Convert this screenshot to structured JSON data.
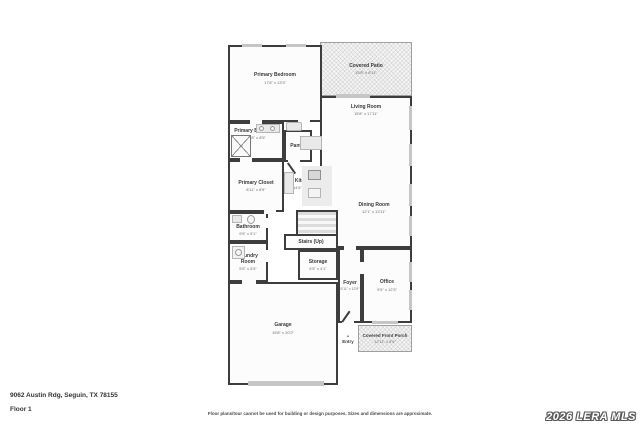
{
  "page": {
    "address": "9062 Austin Rdg, Seguin, TX 78155",
    "floor_label": "Floor 1",
    "disclaimer": "Floor plans/tour cannot be used for building or design purposes. Sizes and dimensions are approximate.",
    "watermark": "2026 LERA MLS"
  },
  "colors": {
    "wall": "#3d3d3d",
    "room_fill": "#fcfcfc",
    "fixture": "#e9e9e9",
    "window_marker": "#c6c6c6",
    "hatch_fill": "#f5f5f5",
    "label_text": "#3a3a3a",
    "dims_text": "#6e6e6e"
  },
  "rooms": {
    "primary_bedroom": {
      "name": "Primary Bedroom",
      "dims": "17'8\" x 13'3\""
    },
    "covered_patio": {
      "name": "Covered Patio",
      "dims": "15'8\" x 8'11\""
    },
    "living_room": {
      "name": "Living Room",
      "dims": "15'8\" x 17'11\""
    },
    "primary_bathroom": {
      "name": "Primary Bathroom",
      "dims": "10'8\" x 8'5\""
    },
    "pantry": {
      "name": "Pantry"
    },
    "primary_closet": {
      "name": "Primary Closet",
      "dims": "8'11\" x 8'9\""
    },
    "kitchen": {
      "name": "Kitchen",
      "dims": "14'6\" x 15'3\""
    },
    "dining_room": {
      "name": "Dining Room",
      "dims": "12'1\" x 13'11\""
    },
    "bathroom": {
      "name": "Bathroom",
      "dims": "9'5\" x 5'1\""
    },
    "laundry_room": {
      "name": "Laundry Room",
      "dims": "5'5\" x 5'9\""
    },
    "stairs": {
      "name": "Stairs (Up)"
    },
    "storage": {
      "name": "Storage",
      "dims": "5'5\" x 4'1\""
    },
    "office": {
      "name": "Office",
      "dims": "9'5\" x 12'3\""
    },
    "foyer": {
      "name": "Foyer",
      "dims": "5'11\" x 12'9\""
    },
    "garage": {
      "name": "Garage",
      "dims": "19'8\" x 20'2\""
    },
    "entry": {
      "name": "Entry"
    },
    "covered_front_porch": {
      "name": "Covered Front Porch",
      "dims": "12'11\" x 5'9\""
    }
  }
}
